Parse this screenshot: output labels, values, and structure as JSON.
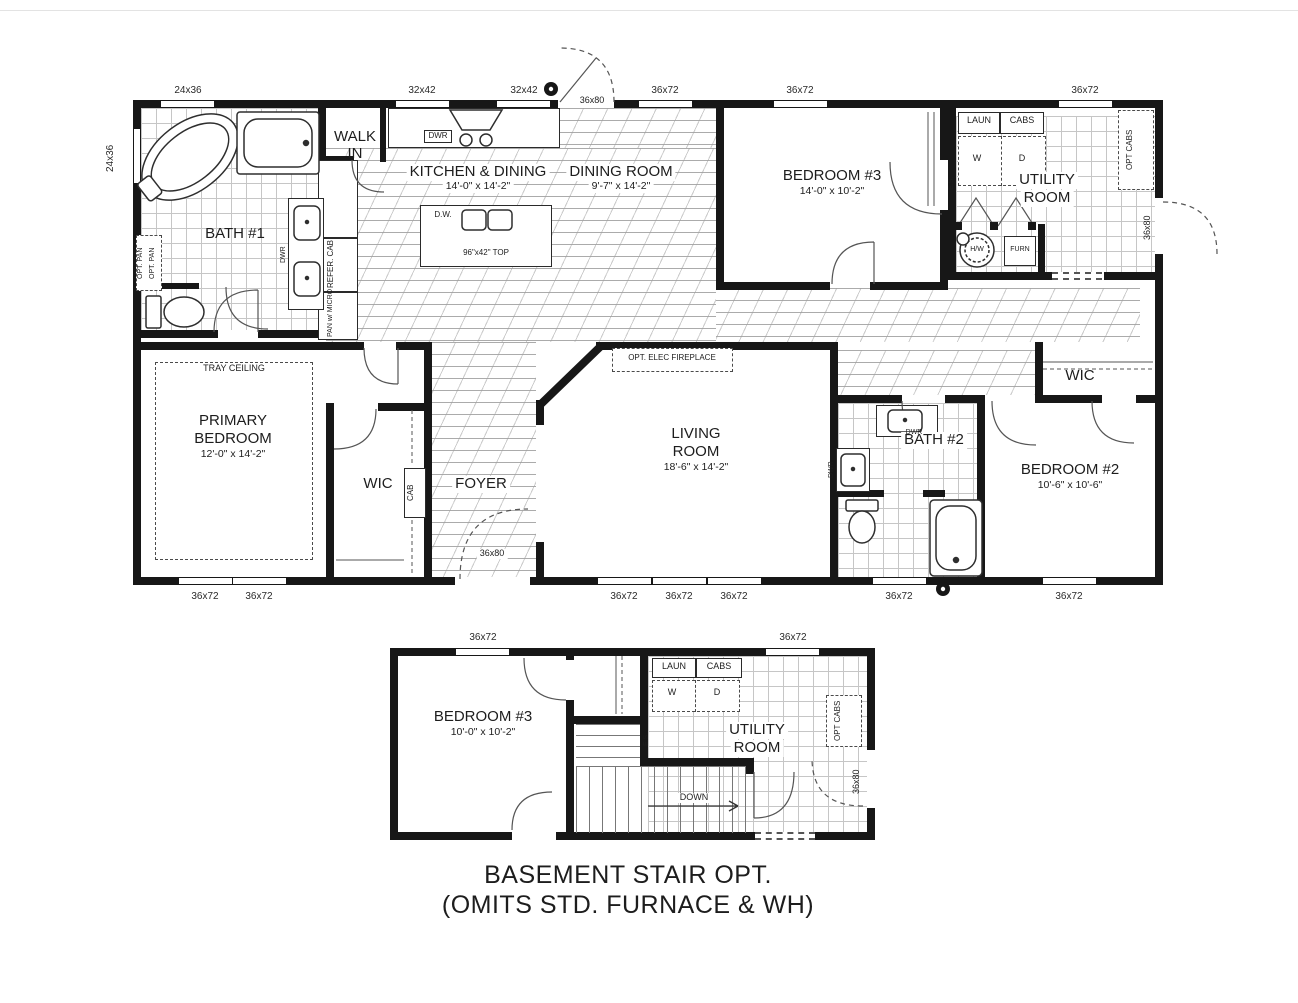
{
  "caption": {
    "line1": "BASEMENT STAIR OPT.",
    "line2": "(OMITS STD. FURNACE & WH)"
  },
  "main": {
    "bath1": "BATH #1",
    "walk1": "WALK",
    "walk2": "IN",
    "kitchen": "KITCHEN & DINING",
    "kitchen_dims": "14'-0\" x 14'-2\"",
    "dining": "DINING ROOM",
    "dining_dims": "9'-7\" x 14'-2\"",
    "bedroom3": "BEDROOM #3",
    "bedroom3_dims": "14'-0\" x 10'-2\"",
    "utility1": "UTILITY",
    "utility2": "ROOM",
    "primary1": "PRIMARY",
    "primary2": "BEDROOM",
    "primary_dims": "12'-0\" x 14'-2\"",
    "tray": "TRAY CEILING",
    "wic": "WIC",
    "cab": "CAB",
    "foyer": "FOYER",
    "living1": "LIVING",
    "living2": "ROOM",
    "living_dims": "18'-6\" x 14'-2\"",
    "fireplace": "OPT. ELEC FIREPLACE",
    "bath2": "BATH #2",
    "bedroom2": "BEDROOM #2",
    "bedroom2_dims": "10'-6\" x 10'-6\"",
    "dwr": "DWR",
    "dw": "D.W.",
    "island_top": "96\"x42\" TOP",
    "refer": "REFER. CAB",
    "pan": "PAN w/ MICRO",
    "optpan": "OPT. PAN",
    "laun": "LAUN",
    "cabs": "CABS",
    "w": "W",
    "d": "D",
    "es": "E.S.",
    "optcabs": "OPT CABS",
    "hw": "H/W",
    "furn": "FURN",
    "door": "36x80",
    "win_top": [
      "24x36",
      "32x42",
      "32x42",
      "36x72",
      "36x72",
      "36x72"
    ],
    "win_left": "24x36",
    "win_bottom": [
      "36x72",
      "36x72",
      "36x72",
      "36x72",
      "36x72",
      "36x72",
      "36x72"
    ]
  },
  "lower": {
    "bedroom3": "BEDROOM #3",
    "bedroom3_dims": "10'-0\" x 10'-2\"",
    "utility1": "UTILITY",
    "utility2": "ROOM",
    "down": "DOWN",
    "laun": "LAUN",
    "cabs": "CABS",
    "w": "W",
    "d": "D",
    "es": "E.S.",
    "optcabs": "OPT CABS",
    "door": "36x80",
    "win_top": [
      "36x72",
      "36x72"
    ]
  }
}
